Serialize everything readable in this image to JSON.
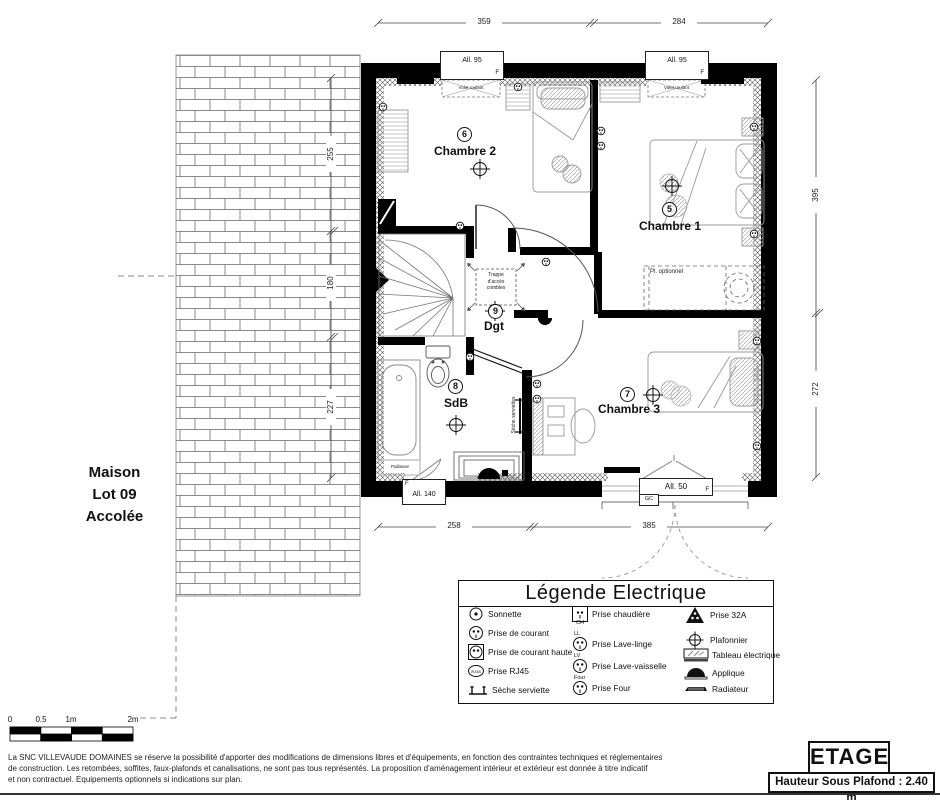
{
  "rooms": {
    "chambre2": {
      "name": "Chambre 2",
      "circuit": "6"
    },
    "chambre1": {
      "name": "Chambre 1",
      "circuit": "5"
    },
    "chambre3": {
      "name": "Chambre 3",
      "circuit": "7"
    },
    "sdb": {
      "name": "SdB",
      "circuit": "8"
    },
    "dgt": {
      "name": "Dgt",
      "circuit": "9"
    }
  },
  "windows": {
    "top_left": {
      "label": "All. 95",
      "f": "F"
    },
    "top_right": {
      "label": "All. 95",
      "f": "F"
    },
    "bottom_left": {
      "label": "All. 140",
      "f": "F"
    },
    "bottom_right": {
      "label": "All. 50",
      "f": "F",
      "gc": "GC"
    }
  },
  "annotations": {
    "volet_roulant": "Volet roulant",
    "trappe_l1": "Trappe",
    "trappe_l2": "d'accès",
    "trappe_l3": "combles",
    "pl_optionnel": "Pl. optionnel",
    "seche_serviettes": "Sèche serviettes",
    "paillasse": "Paillasse"
  },
  "neighbor": {
    "l1": "Maison",
    "l2": "Lot 09",
    "l3": "Accolée"
  },
  "dimensions": {
    "top_left_seg": "359",
    "top_right_seg": "284",
    "bottom_left_seg": "258",
    "bottom_right_seg": "385",
    "left_1": "255",
    "left_2": "180",
    "left_3": "227",
    "right_1": "395",
    "right_2": "272"
  },
  "scale_bar": {
    "t0": "0",
    "t05": "0.5",
    "t1": "1m",
    "t2": "2m"
  },
  "legend": {
    "title": "Légende Electrique",
    "col1": [
      {
        "label": "Sonnette"
      },
      {
        "label": "Prise de courant"
      },
      {
        "label": "Prise de courant haute"
      },
      {
        "label": "Prise RJ45",
        "glyph": "RJ45"
      },
      {
        "label": "Sèche serviette"
      }
    ],
    "col2": [
      {
        "label": "Prise chaudière",
        "tag": "CH"
      },
      {
        "label": "Prise Lave-linge",
        "tag": "LL"
      },
      {
        "label": "Prise Lave-vaisselle",
        "tag": "LV"
      },
      {
        "label": "Prise Four",
        "tag": "Four"
      }
    ],
    "col3": [
      {
        "label": "Prise 32A"
      },
      {
        "label": "Plafonnier"
      },
      {
        "label": "Tableau électrique"
      },
      {
        "label": "Applique"
      },
      {
        "label": "Radiateur"
      }
    ]
  },
  "footer": {
    "disclaimer_l1": "La SNC VILLEVAUDE DOMAINES se réserve la possibilité d'apporter des modifications de dimensions libres et d'équipements, en fonction des contraintes techniques et réglementaires",
    "disclaimer_l2": "de construction. Les retombées, soffites, faux-plafonds et canalisations, ne sont pas tous représentés. La proposition d'aménagement intérieur et extérieur est donnée à titre indicatif",
    "disclaimer_l3": "et non contractuel. Equipements optionnels si indications sur plan.",
    "etage": "ETAGE",
    "hauteur": "Hauteur Sous Plafond : 2.40 m"
  },
  "colors": {
    "wall": "#000000",
    "dimline": "#444444",
    "furniture": "#999999",
    "brick_line": "#8a8a8a"
  }
}
